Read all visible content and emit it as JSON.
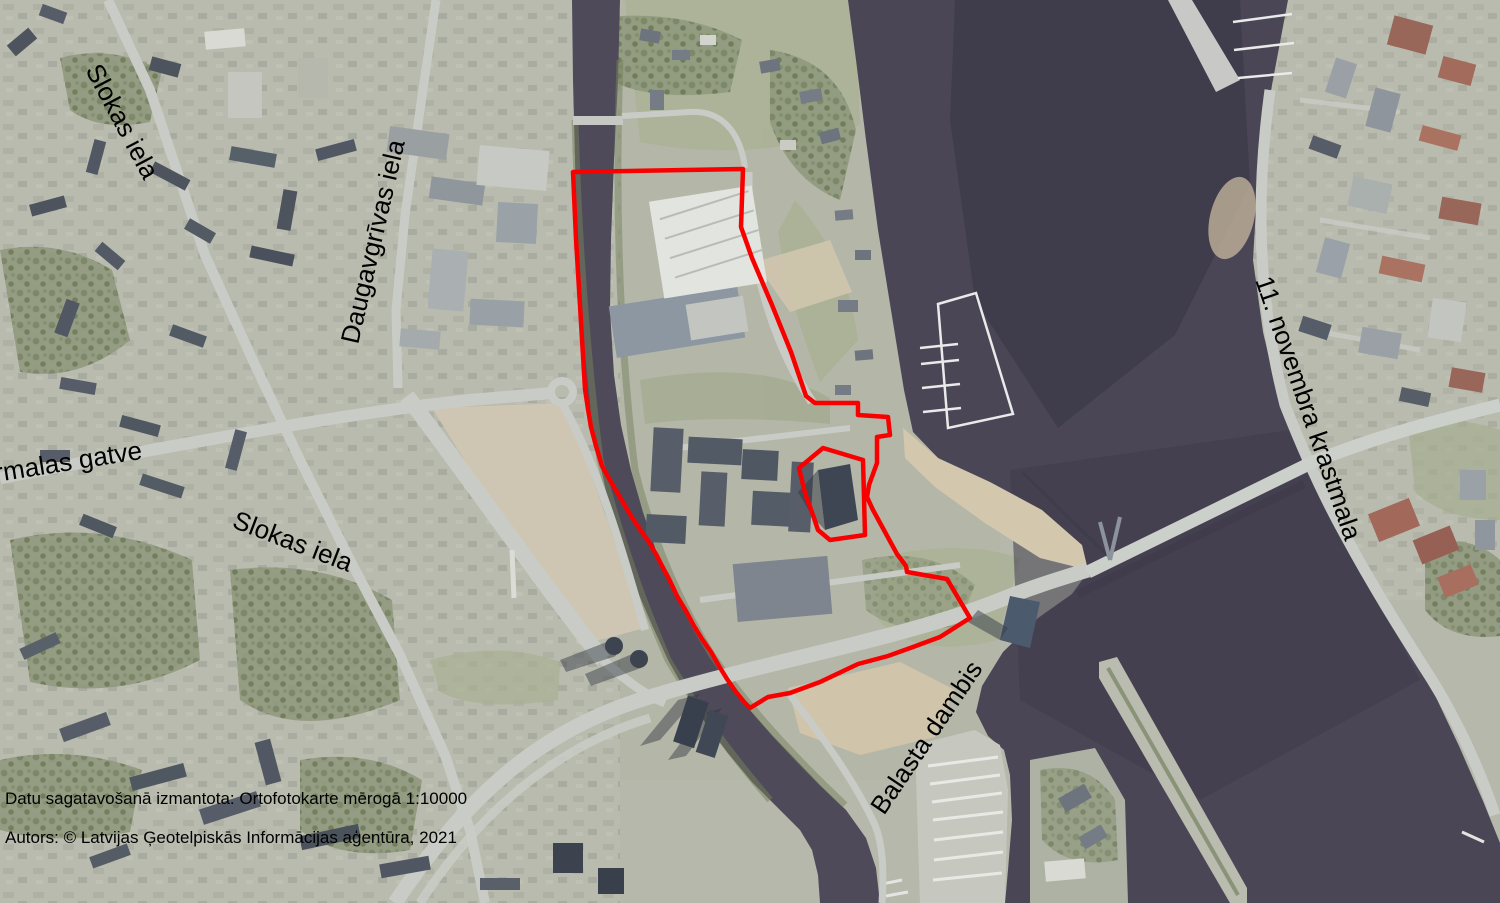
{
  "map": {
    "type": "orthophoto-map",
    "street_labels": [
      {
        "id": "slokas-top",
        "text": "Slokas iela"
      },
      {
        "id": "daugavgrivas",
        "text": "Daugavgrīvas iela"
      },
      {
        "id": "jurmalas",
        "text": "rmalas gatve"
      },
      {
        "id": "slokas-mid",
        "text": "Slokas iela"
      },
      {
        "id": "novembra",
        "text": "11. novembra krastmala"
      },
      {
        "id": "balasta",
        "text": "Balasta dambis"
      }
    ],
    "credits": {
      "line1": "Datu sagatavošanā izmantota: Ortofotokarte mērogā 1:10000",
      "line2": "Autors: © Latvijas Ģeotelpiskās Informācijas aģentūra, 2021"
    },
    "colors": {
      "boundary": "#f80000",
      "water": "#4a4656",
      "land": "#b6b8ab",
      "sand": "#d3c7ad",
      "road": "#c9ccc6"
    }
  }
}
